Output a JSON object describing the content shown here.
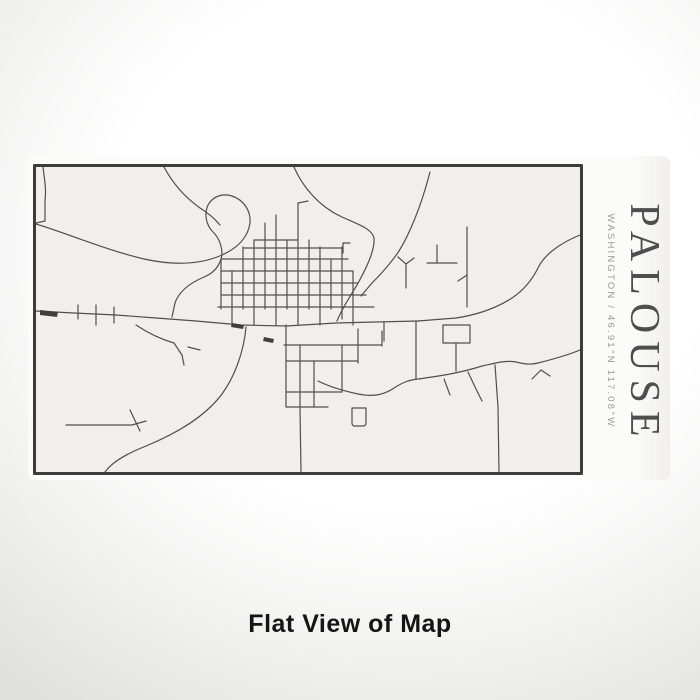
{
  "product": {
    "title": "PALOUSE",
    "subtitle": "WASHINGTON / 46.91°N 117.08°W",
    "caption": "Flat View of Map"
  },
  "colors": {
    "title_text": "#4e4e4e",
    "subtitle_text": "#9a9a9a",
    "caption_text": "#151515",
    "map_border": "#3c3c3c",
    "map_background": "#f0efee",
    "label_background": "#fbfbfa"
  },
  "map": {
    "place": "Palouse, Washington street map",
    "street_color": "#4f4f4f",
    "street_width": 1.2,
    "building_color": "#3f3f3f",
    "streets": [
      "M7,0 L9,16 Q10,25 9,33 L9,54 L0,56",
      "M0,57 C30,66 70,83 108,92 C140,99 166,97 186,88 C202,81 212,70 214,56 C215,44 208,33 196,29 C187,26 177,29 172,38 C168,47 170,58 177,65 C183,71 186,79 186,88",
      "M186,88 C184,99 178,106 168,110 C154,116 143,124 139,136 L136,150",
      "M128,0 C137,17 150,31 164,41 C172,46 179,52 184,58",
      "M258,0 C267,21 284,40 306,50 C324,58 336,62 338,71 C339,83 331,100 321,118 C313,131 306,142 301,154",
      "M394,5 C385,40 373,68 363,84 C355,96 346,106 336,116 L325,129",
      "M544,68 C524,76 508,88 502,101 C496,113 488,123 476,131 C459,142 440,148 420,151 L382,154",
      "M0,144 L38,146 L80,148 L120,151 L160,154 L205,158 L250,159 L300,156 L340,155 L382,154",
      "M42,138 L42,152",
      "M60,138 L60,158",
      "M78,140 L78,156",
      "M210,160 C208,184 199,209 186,227 C168,251 139,267 110,279 C90,287 76,295 69,305",
      "M30,258 L96,258 L110,254",
      "M94,243 L104,264",
      "M282,214 C294,220 308,224 322,227 C336,230 348,228 358,221 C366,216 372,213 382,212 C404,209 424,206 446,199 C460,196 470,193 480,195 C488,197 494,198 502,196 C518,192 532,188 544,183",
      "M380,154 L380,212",
      "M348,156 L348,174",
      "M459,198 L462,240 L463,305",
      "M432,205 L440,222 L446,234",
      "M408,212 L414,228",
      "M496,212 L505,203 L514,209",
      "M264,241 L265,305",
      "M185,92 L185,142",
      "M196,104 L196,158",
      "M207,80 L207,142",
      "M218,73 L218,158",
      "M229,56 L229,142",
      "M240,48 L240,158",
      "M251,73 L251,142",
      "M262,36 L262,158",
      "M262,36 L272,34",
      "M273,73 L273,142",
      "M284,80 L284,158",
      "M295,92 L295,142",
      "M306,80 L306,152",
      "M317,104 L317,158",
      "M218,73 L262,73",
      "M207,81 L306,81",
      "M185,92 L312,92",
      "M185,104 L317,104",
      "M185,116 L322,116",
      "M185,128 L330,128",
      "M182,140 L338,140",
      "M250,158 L250,240",
      "M264,178 L264,241",
      "M278,194 L278,240",
      "M306,178 L306,225",
      "M322,162 L322,196",
      "M346,164 L346,179",
      "M248,178 L346,178",
      "M250,194 L322,194",
      "M250,225 L306,225",
      "M250,240 L292,240",
      "M316,241 L330,241 L330,256 Q330,259 327,259 L319,259 Q316,259 316,256 L316,241",
      "M391,96 L421,96",
      "M401,78 L401,96",
      "M431,60 L431,140",
      "M431,108 L422,114",
      "M362,90 L370,97 L378,91",
      "M370,97 L370,121",
      "M307,86 L307,76 L314,76",
      "M407,158 L434,158 L434,176 L407,176 L407,158",
      "M420,176 L420,204",
      "M100,158 C112,166 124,172 138,176",
      "M138,176 L146,188 L148,198",
      "M152,180 L164,183"
    ],
    "buildings": [
      "M4,143 L22,145 L21,150 L4,148 Z",
      "M196,156 L208,158 L207,162 L195,160 Z",
      "M228,170 L238,172 L237,176 L227,174 Z"
    ]
  }
}
